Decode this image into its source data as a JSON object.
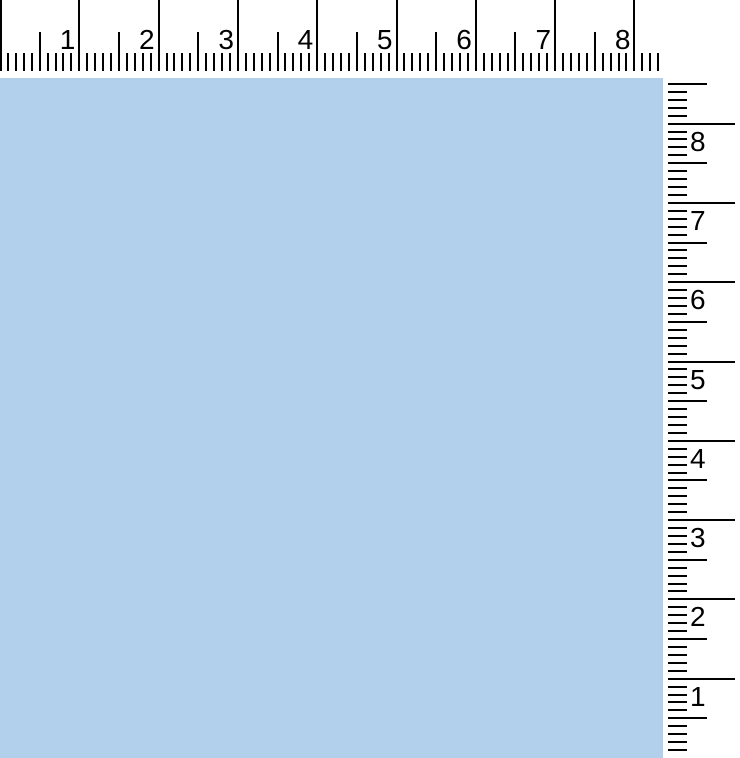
{
  "horizontal_ruler": {
    "labels": [
      "1",
      "2",
      "3",
      "4",
      "5",
      "6",
      "7",
      "8"
    ]
  },
  "vertical_ruler": {
    "labels": [
      "8",
      "7",
      "6",
      "5",
      "4",
      "3",
      "2",
      "1"
    ]
  },
  "colors": {
    "canvas": "#b2cfec",
    "ruler_background": "#ffffff",
    "tick": "#000000",
    "number": "#000000"
  }
}
